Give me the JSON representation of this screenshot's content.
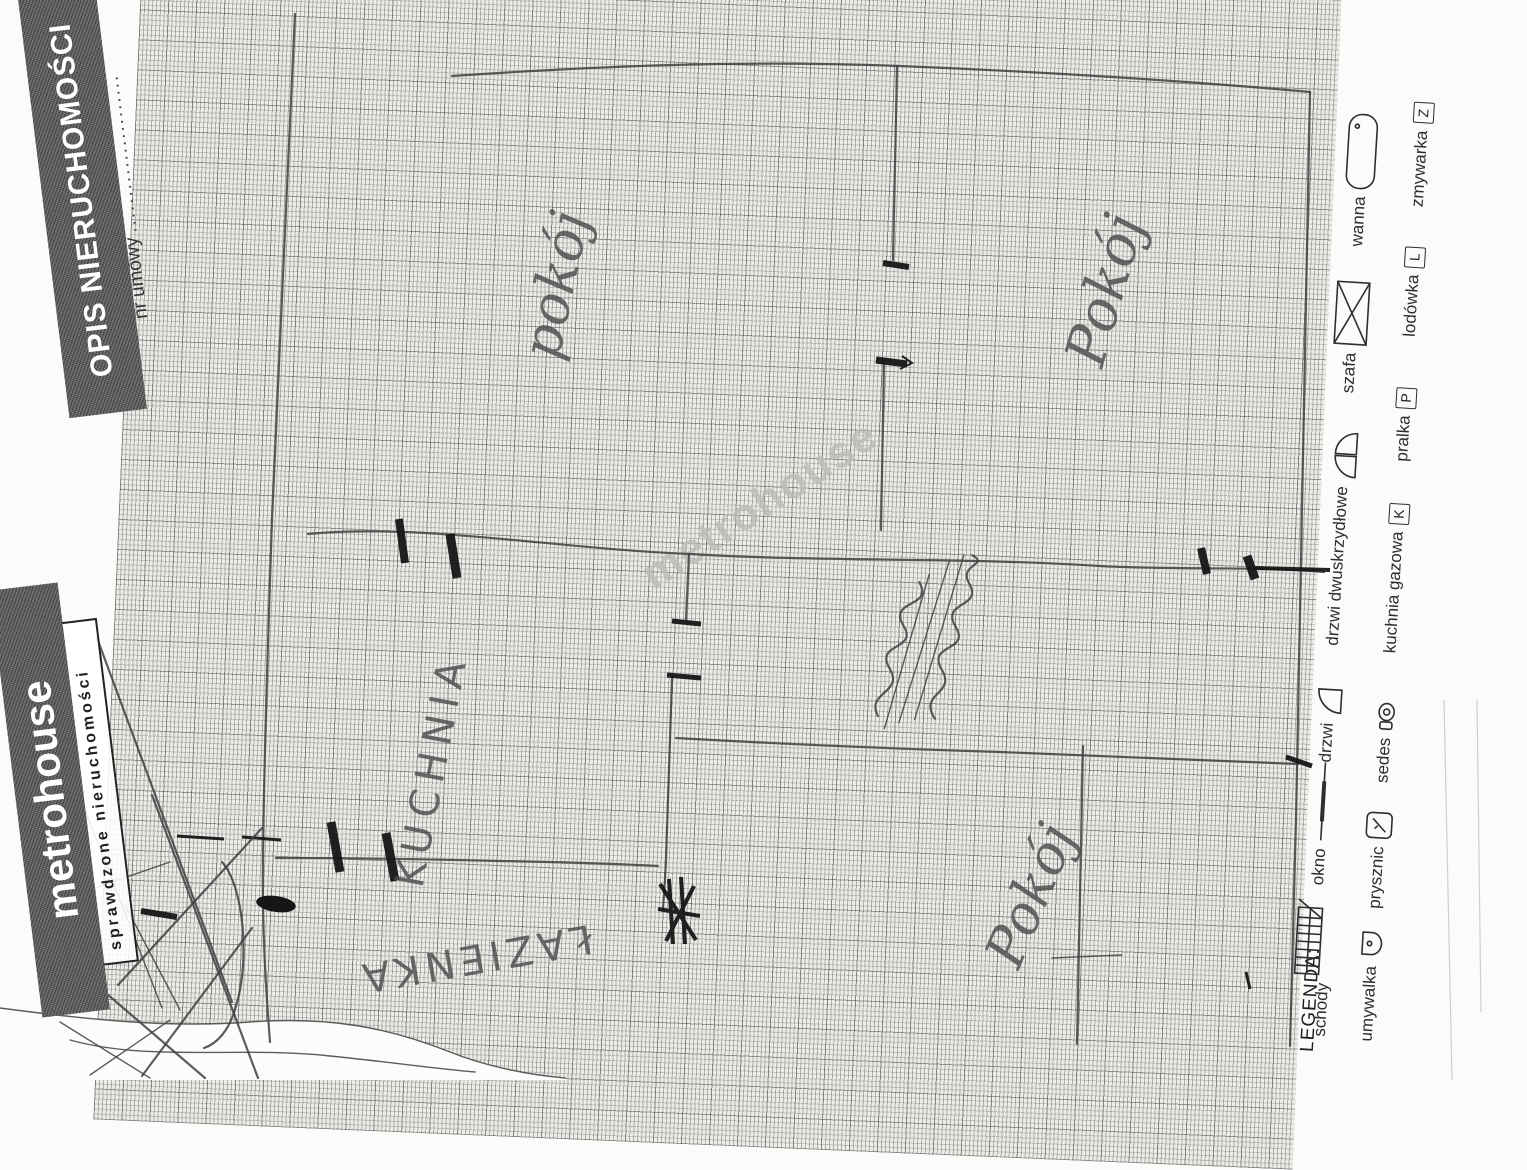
{
  "document": {
    "header_title": "OPIS NIERUCHOMOŚCI",
    "contract_number_label": "nr umowy",
    "contract_number_dots": "......................",
    "logo_text": "metrohouse",
    "logo_tagline": "sprawdzone nieruchomości",
    "watermark_text": "metrohouse"
  },
  "legend": {
    "title": "LEGENDA:",
    "row1": [
      {
        "label": "schody"
      },
      {
        "label": "okno"
      },
      {
        "label": "drzwi"
      },
      {
        "label": "drzwi dwuskrzydłowe"
      },
      {
        "label": "szafa"
      },
      {
        "label": "wanna"
      }
    ],
    "row2": [
      {
        "label": "umywalka"
      },
      {
        "label": "prysznic"
      },
      {
        "label": "sedes"
      },
      {
        "label": "kuchnia gazowa",
        "symbol": "K"
      },
      {
        "label": "pralka",
        "symbol": "P"
      },
      {
        "label": "lodówka",
        "symbol": "L"
      },
      {
        "label": "zmywarka",
        "symbol": "Z"
      }
    ]
  },
  "plan": {
    "room_labels": [
      {
        "text": "pokój"
      },
      {
        "text": "Pokój"
      },
      {
        "text": "KUCHNIA"
      },
      {
        "text": "ŁAZIENKA"
      },
      {
        "text": "Pokój"
      }
    ]
  },
  "colors": {
    "pencil": "#3f3f3f",
    "ink": "#161616",
    "paper": "#edece8",
    "band": "#5b5b5b"
  }
}
